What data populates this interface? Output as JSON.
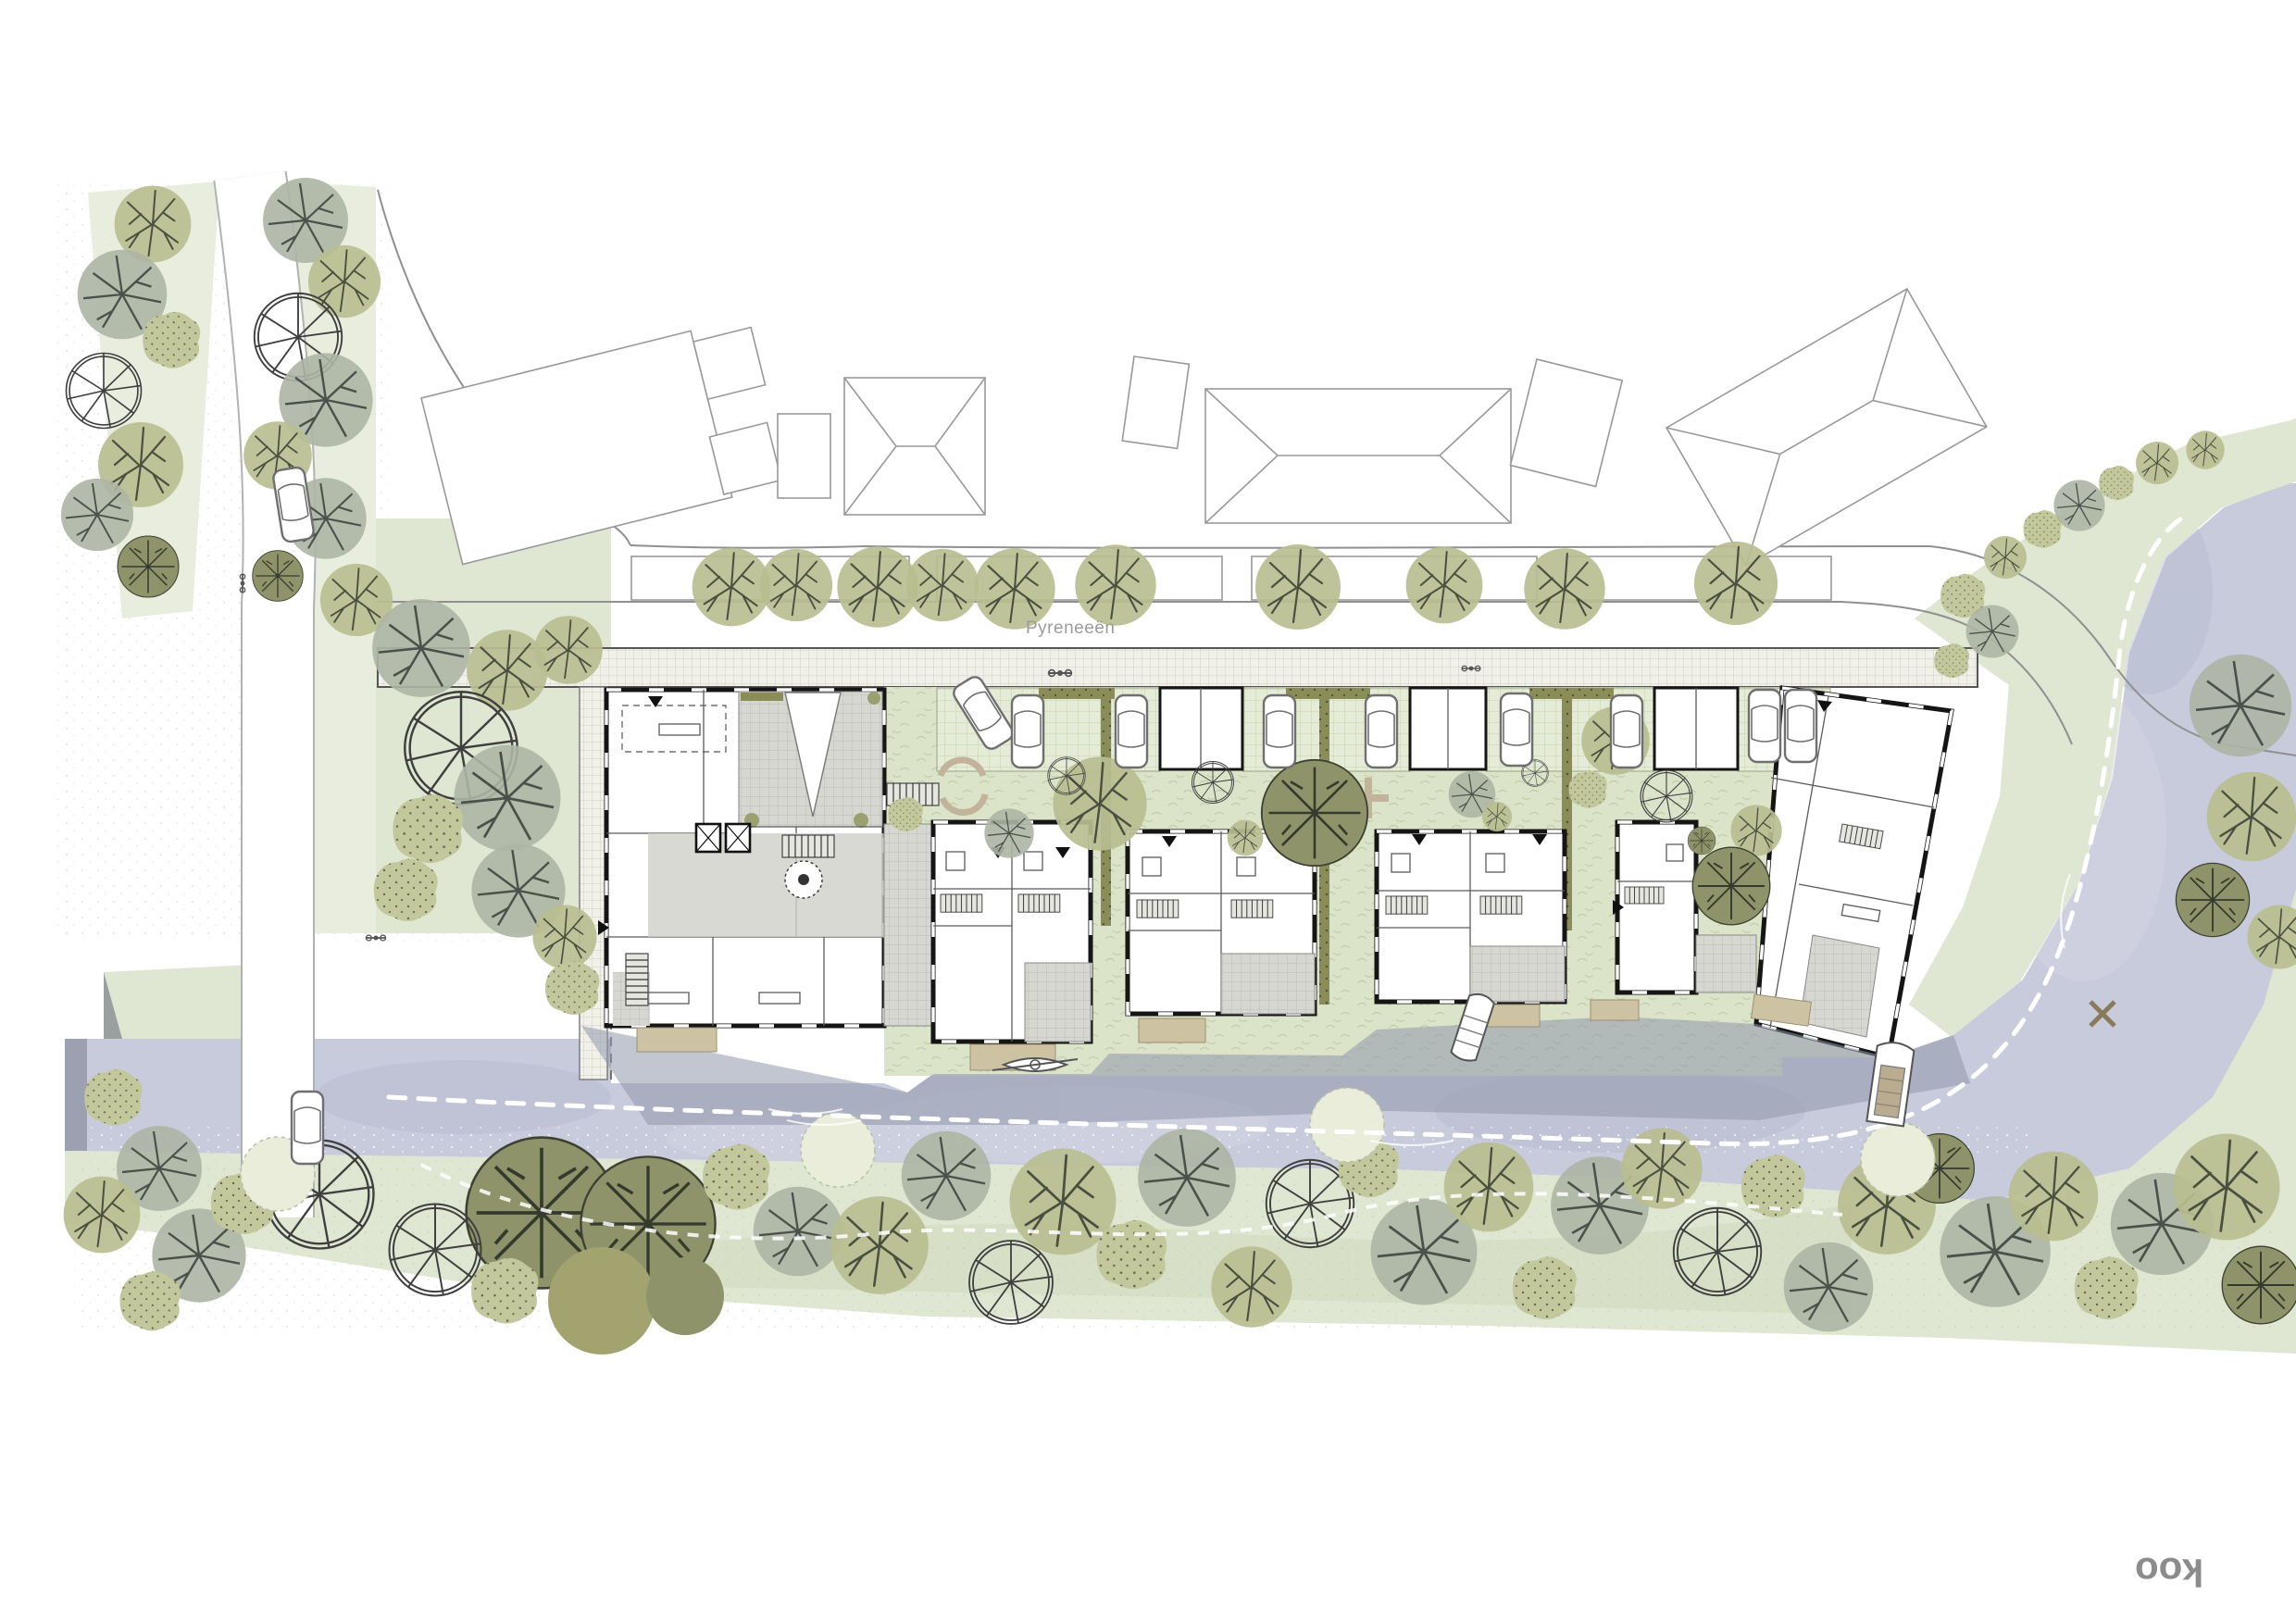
{
  "page": {
    "kind": "architectural site plan drawing",
    "background": "#ffffff"
  },
  "labels": {
    "street_name": "Pyreneeën"
  },
  "logo": {
    "oo": "oo",
    "k": "k",
    "color": "#8c8c8c"
  },
  "palette": {
    "water": "#c7cbdb",
    "bank_green": "#dfe6d1",
    "lawn": "#dbe3c9",
    "verge": "#e8edde",
    "parking_paving": "#e5ebd7",
    "sidewalk_paving": "#f1f1ea",
    "terrace_paving": "#d7d7d1",
    "deck_wood": "#cdc2a2",
    "tree_olive": "#b9be90",
    "tree_dark_olive": "#8e9369",
    "tree_gray_green": "#adb5a4",
    "hedge": "#8b8d58",
    "building_wall": "#151515",
    "context_outline": "#999999"
  },
  "features": {
    "street_tree_count": 10,
    "parked_cars": 9,
    "cars_on_road": 2,
    "boats": [
      "kayak",
      "rowboat",
      "motorboat"
    ],
    "navigation_channel": "white dashed line in canal",
    "footpath": "white dashed line through south bank trees",
    "buildings": {
      "apartment_block": 1,
      "townhouse_pairs": 3,
      "single_townhouse": 1,
      "tilted_end_block": 1,
      "garden_sheds": 3,
      "context_buildings": 7
    }
  }
}
